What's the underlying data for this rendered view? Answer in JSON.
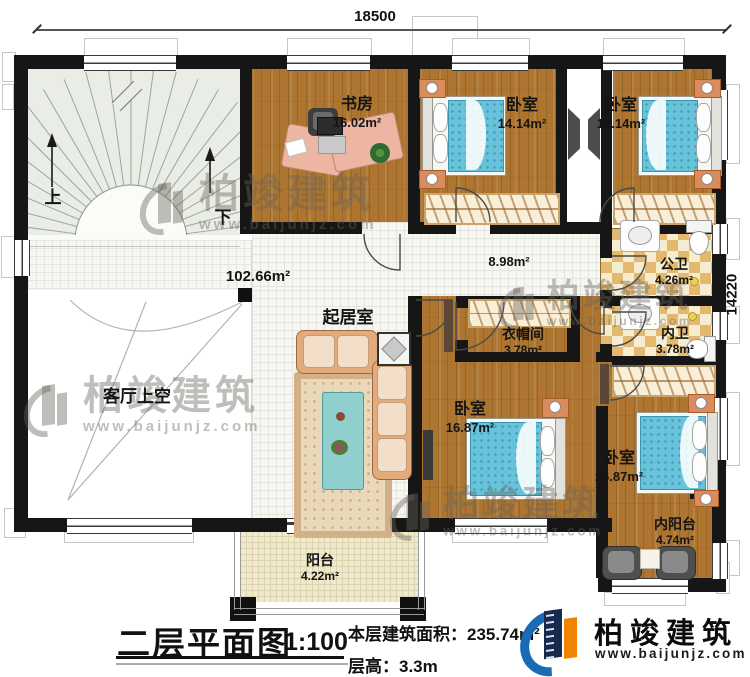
{
  "dimensions": {
    "top": "18500",
    "right": "14220"
  },
  "stairs": {
    "up": "上",
    "down": "下"
  },
  "rooms": {
    "study": {
      "name": "书房",
      "area": "16.02m²"
    },
    "bedroom1": {
      "name": "卧室",
      "area": "14.14m²"
    },
    "bedroom2": {
      "name": "卧室",
      "area": "14.14m²"
    },
    "public_bath": {
      "name": "公卫",
      "area": "4.26m²"
    },
    "inner_bath": {
      "name": "内卫",
      "area": "3.78m²"
    },
    "cloakroom": {
      "name": "衣帽间",
      "area": "3.78m²"
    },
    "bedroom3": {
      "name": "卧室",
      "area": "16.87m²"
    },
    "bedroom4": {
      "name": "卧室",
      "area": "16.87m²"
    },
    "balcony": {
      "name": "阳台",
      "area": "4.22m²"
    },
    "inner_balcony": {
      "name": "内阳台",
      "area": "4.74m²"
    },
    "family_room": {
      "name": "起居室"
    },
    "living_void": {
      "name": "客厅上空"
    }
  },
  "open_areas": {
    "hall_area": "102.66m²",
    "corridor_area": "8.98m²"
  },
  "title_block": {
    "plan_title": "二层平面图",
    "scale": "1:100",
    "floor_area_label": "本层建筑面积：",
    "floor_area_value": "235.74m²",
    "floor_height_label": "层高：",
    "floor_height_value": "3.3m"
  },
  "brand": {
    "name": "柏竣建筑",
    "url": "www.baijunjz.com"
  },
  "watermark": {
    "name": "柏竣建筑",
    "url": "www.baijunjz.com"
  },
  "colors": {
    "wall": "#161616",
    "wood_floor": "#ad752f",
    "bed_blue": "#68c3da",
    "sofa_tan": "#e3ab7c",
    "bath_checker": "#e3b970",
    "logo_blue": "#1a6bb5",
    "logo_navy": "#16294f",
    "logo_orange": "#f08300"
  }
}
